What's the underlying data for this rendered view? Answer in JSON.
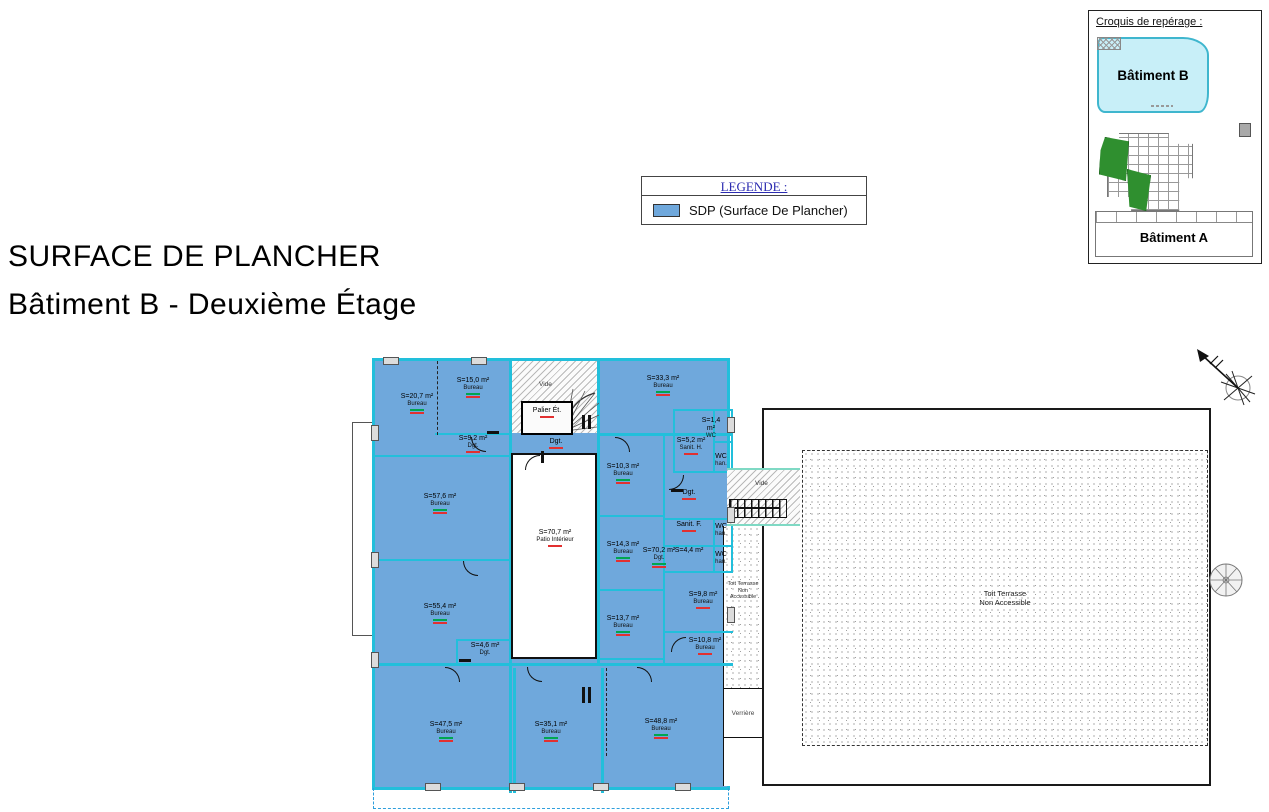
{
  "page": {
    "title_line1": "SURFACE DE PLANCHER",
    "title_line2": "Bâtiment B - Deuxième Étage"
  },
  "legend": {
    "header": "LEGENDE :",
    "item": {
      "label": "SDP (Surface De Plancher)",
      "swatch_color": "#6FA8DC"
    }
  },
  "croquis": {
    "title": "Croquis de repérage :",
    "building_b": "Bâtiment B",
    "building_a": "Bâtiment A"
  },
  "plan": {
    "vide_top": "Vide",
    "vide_connector": "Vide",
    "verriere": "Verrière",
    "terrace_strip": {
      "line1": "Toit Terrasse",
      "line2": "Non Accessible"
    },
    "terrace_main": {
      "line1": "Toit Terrasse",
      "line2": "Non Accessible"
    },
    "rooms": [
      {
        "line1": "S=20,7 m²",
        "line2": "Bureau"
      },
      {
        "line1": "S=15,0 m²",
        "line2": "Bureau"
      },
      {
        "line1": "S=9,2 m²",
        "line2": "Dgt."
      },
      {
        "line1": "Palier Ét.",
        "line2": ""
      },
      {
        "line1": "Dgt.",
        "line2": ""
      },
      {
        "line1": "S=33,3 m²",
        "line2": "Bureau"
      },
      {
        "line1": "S=1,4 m²",
        "line2": "WC"
      },
      {
        "line1": "S=5,2 m²",
        "line2": "Sanit. H."
      },
      {
        "line1": "WC",
        "line2": "han."
      },
      {
        "line1": "Dgt.",
        "line2": ""
      },
      {
        "line1": "S=70,2 m²",
        "line2": "Dgt."
      },
      {
        "line1": "Sanit. F.",
        "line2": ""
      },
      {
        "line1": "WC",
        "line2": "han."
      },
      {
        "line1": "S=4,4 m²",
        "line2": ""
      },
      {
        "line1": "WC",
        "line2": "han."
      },
      {
        "line1": "S=10,3 m²",
        "line2": "Bureau"
      },
      {
        "line1": "S=14,3 m²",
        "line2": "Bureau"
      },
      {
        "line1": "S=13,7 m²",
        "line2": "Bureau"
      },
      {
        "line1": "S=9,8 m²",
        "line2": "Bureau"
      },
      {
        "line1": "S=10,8 m²",
        "line2": "Bureau"
      },
      {
        "line1": "S=57,6 m²",
        "line2": "Bureau"
      },
      {
        "line1": "S=55,4 m²",
        "line2": "Bureau"
      },
      {
        "line1": "S=4,6 m²",
        "line2": "Dgt."
      },
      {
        "line1": "S=47,5 m²",
        "line2": "Bureau"
      },
      {
        "line1": "S=35,1 m²",
        "line2": "Bureau"
      },
      {
        "line1": "S=48,8 m²",
        "line2": "Bureau"
      },
      {
        "line1": "S=70,7 m²",
        "line2": "Patio Intérieur"
      }
    ]
  },
  "colors": {
    "sdp_fill": "#6FA8DC",
    "wall_cyan": "#22BFDB",
    "legend_header": "#2B2BB0",
    "croquis_b_fill": "#C8EFF8",
    "green_annotation": "#00A650",
    "red_annotation": "#E23030"
  }
}
